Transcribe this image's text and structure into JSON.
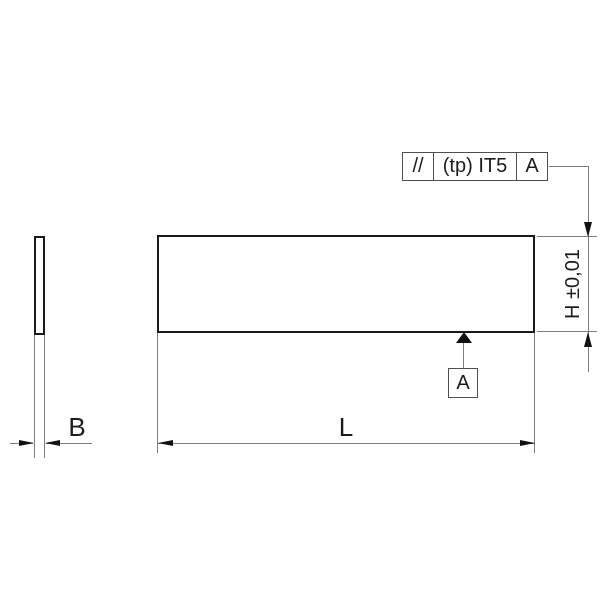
{
  "feature_control_frame": {
    "parallelism_symbol": "//",
    "tolerance": "(tp) IT5",
    "datum_reference": "A"
  },
  "datum": {
    "label": "A"
  },
  "dimensions": {
    "width_label": "B",
    "length_label": "L",
    "height_label": "H ±0,01"
  },
  "colors": {
    "outline": "#1a1a1a",
    "thin_line": "#7d7d7d",
    "frame_border": "#4f4f4f",
    "arrow": "#111111",
    "background": "#ffffff"
  }
}
